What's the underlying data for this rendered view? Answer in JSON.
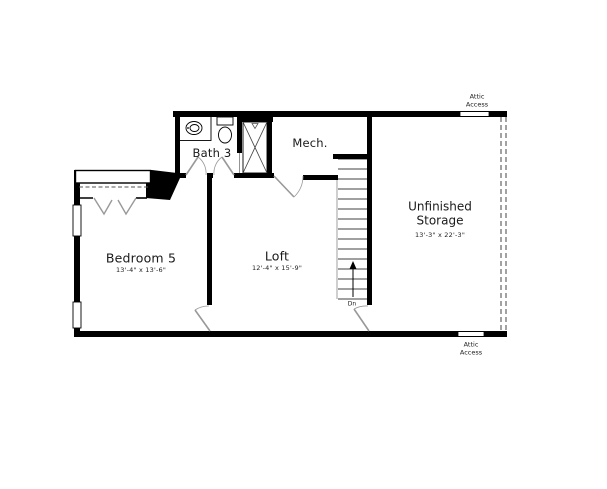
{
  "title": "Second floor plan",
  "rooms": {
    "bedroom5": {
      "name": "Bedroom 5",
      "dims": "13'-4\" x 13'-6\""
    },
    "loft": {
      "name": "Loft",
      "dims": "12'-4\" x 15'-9\""
    },
    "bath3": {
      "name": "Bath 3"
    },
    "mech": {
      "name": "Mech."
    },
    "storage": {
      "name": "Unfinished Storage",
      "dims": "13'-3\" x 22'-3\""
    }
  },
  "annotations": {
    "attic_access_top": "Attic Access",
    "attic_access_bottom": "Attic Access",
    "stairs_direction": "Dn"
  },
  "colors": {
    "wall": "#000000",
    "door": "#999999",
    "background": "#ffffff"
  }
}
